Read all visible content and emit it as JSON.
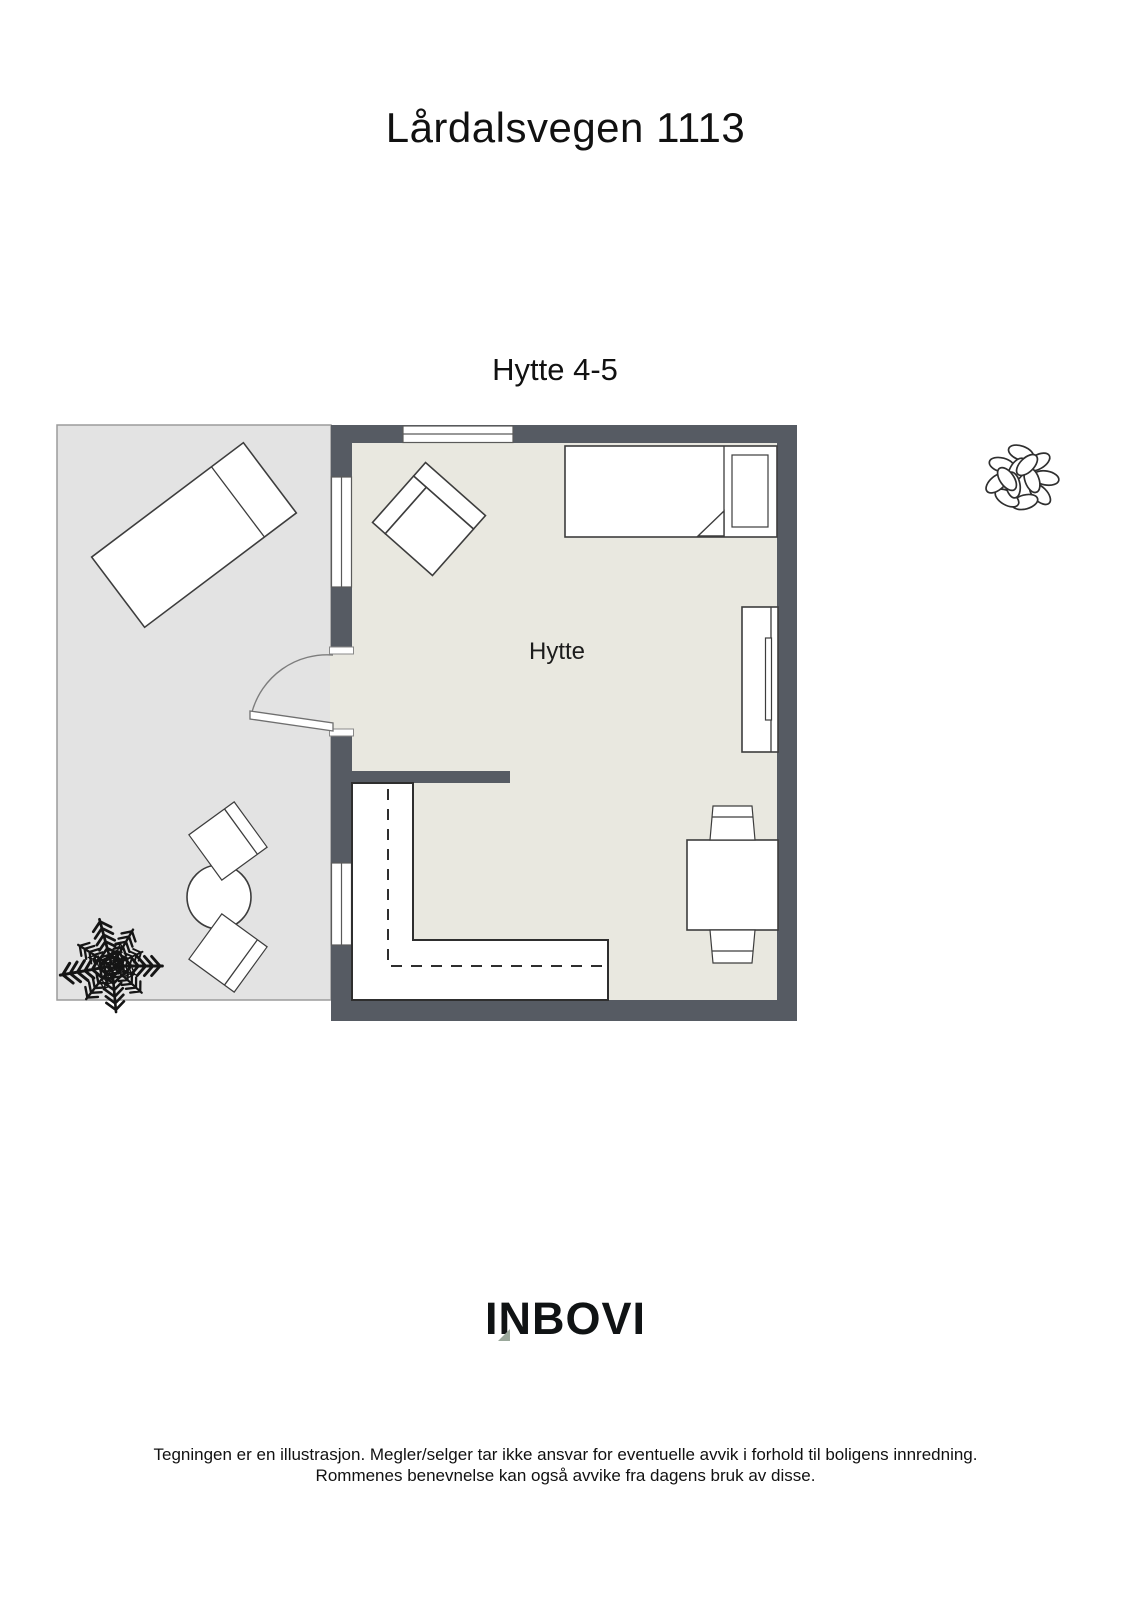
{
  "page": {
    "title": "Lårdalsvegen 1113",
    "subtitle": "Hytte 4-5",
    "logo_text": "INBOVI",
    "disclaimer_line1": "Tegningen er en illustrasjon. Megler/selger tar ikke ansvar for eventuelle avvik i forhold til boligens innredning.",
    "disclaimer_line2": "Rommenes benevnelse kan også avvike fra dagens bruk av disse."
  },
  "floorplan": {
    "room_label": "Hytte",
    "colors": {
      "wall": "#565b63",
      "floor": "#e9e8e0",
      "terrace": "#e3e3e3",
      "logo_accent": "#9aa89b"
    },
    "furniture_icons": [
      "sun-lounger-icon",
      "outdoor-round-table-icon",
      "outdoor-chair-icon",
      "outdoor-chair-icon",
      "potted-plant-icon",
      "shrub-icon",
      "armchair-icon",
      "single-bed-icon",
      "wardrobe-icon",
      "kitchen-counter-icon",
      "dining-table-icon",
      "dining-chair-icon",
      "dining-chair-icon",
      "door-swing-icon",
      "window-icon"
    ]
  }
}
